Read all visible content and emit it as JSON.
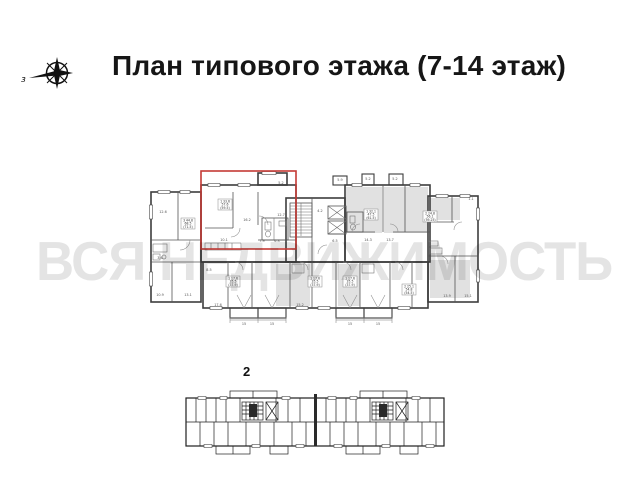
{
  "header": {
    "title": "План типового этажа (7-14 этаж)"
  },
  "compass": {
    "west_label": "з"
  },
  "watermark": {
    "text": "ВСЯ НЕДВИЖИМОСТЬ",
    "color": "#e4e4e4"
  },
  "main_plan": {
    "highlight_color": "#c43a35",
    "stamps": [
      {
        "x": 181,
        "y": 218,
        "lines": [
          "3 44.8",
          "68.5",
          "(71.5)"
        ]
      },
      {
        "x": 218,
        "y": 199,
        "lines": [
          "1 33.6",
          "57.6",
          "(59.5)"
        ]
      },
      {
        "x": 364,
        "y": 209,
        "lines": [
          "1 32.1",
          "47.5",
          "(61.5)"
        ]
      },
      {
        "x": 423,
        "y": 211,
        "lines": [
          "2 24.8",
          "56.1",
          "(59.25)"
        ]
      },
      {
        "x": 226,
        "y": 276,
        "lines": [
          "1 17.6",
          "35.5",
          "(37.9)"
        ]
      },
      {
        "x": 308,
        "y": 276,
        "lines": [
          "1 17.6",
          "35.5",
          "(37.9)"
        ]
      },
      {
        "x": 343,
        "y": 276,
        "lines": [
          "1 17.6",
          "35.5",
          "(37.9)"
        ]
      },
      {
        "x": 402,
        "y": 284,
        "lines": [
          "2 25.1",
          "54.8",
          "(54.5)"
        ]
      }
    ],
    "dims": [
      {
        "text": "5.2",
        "x": 281,
        "y": 184
      },
      {
        "text": "5.9",
        "x": 340,
        "y": 181
      },
      {
        "text": "5.2",
        "x": 368,
        "y": 180
      },
      {
        "text": "5.2",
        "x": 395,
        "y": 180
      },
      {
        "text": "1.1",
        "x": 471,
        "y": 200
      },
      {
        "text": "12.6",
        "x": 163,
        "y": 213
      },
      {
        "text": "16.2",
        "x": 247,
        "y": 221
      },
      {
        "text": "12.7",
        "x": 281,
        "y": 216
      },
      {
        "text": "10.1",
        "x": 224,
        "y": 241
      },
      {
        "text": "7.9",
        "x": 262,
        "y": 242
      },
      {
        "text": "6.3",
        "x": 277,
        "y": 242
      },
      {
        "text": "3.6",
        "x": 160,
        "y": 259
      },
      {
        "text": "4.2",
        "x": 320,
        "y": 212
      },
      {
        "text": "6.5",
        "x": 335,
        "y": 242
      },
      {
        "text": "14.3",
        "x": 368,
        "y": 241
      },
      {
        "text": "13.7",
        "x": 390,
        "y": 241
      },
      {
        "text": "10.9",
        "x": 160,
        "y": 296
      },
      {
        "text": "13.1",
        "x": 188,
        "y": 296
      },
      {
        "text": "8.5",
        "x": 209,
        "y": 271
      },
      {
        "text": "13.9",
        "x": 447,
        "y": 297
      },
      {
        "text": "15.1",
        "x": 468,
        "y": 297
      },
      {
        "text": "17.6",
        "x": 218,
        "y": 306
      },
      {
        "text": "15.2",
        "x": 300,
        "y": 306
      },
      {
        "text": "15",
        "x": 244,
        "y": 325
      },
      {
        "text": "15",
        "x": 272,
        "y": 325
      },
      {
        "text": "15",
        "x": 350,
        "y": 325
      },
      {
        "text": "15",
        "x": 378,
        "y": 325
      }
    ]
  },
  "lower_plan": {
    "section_label": "2"
  }
}
